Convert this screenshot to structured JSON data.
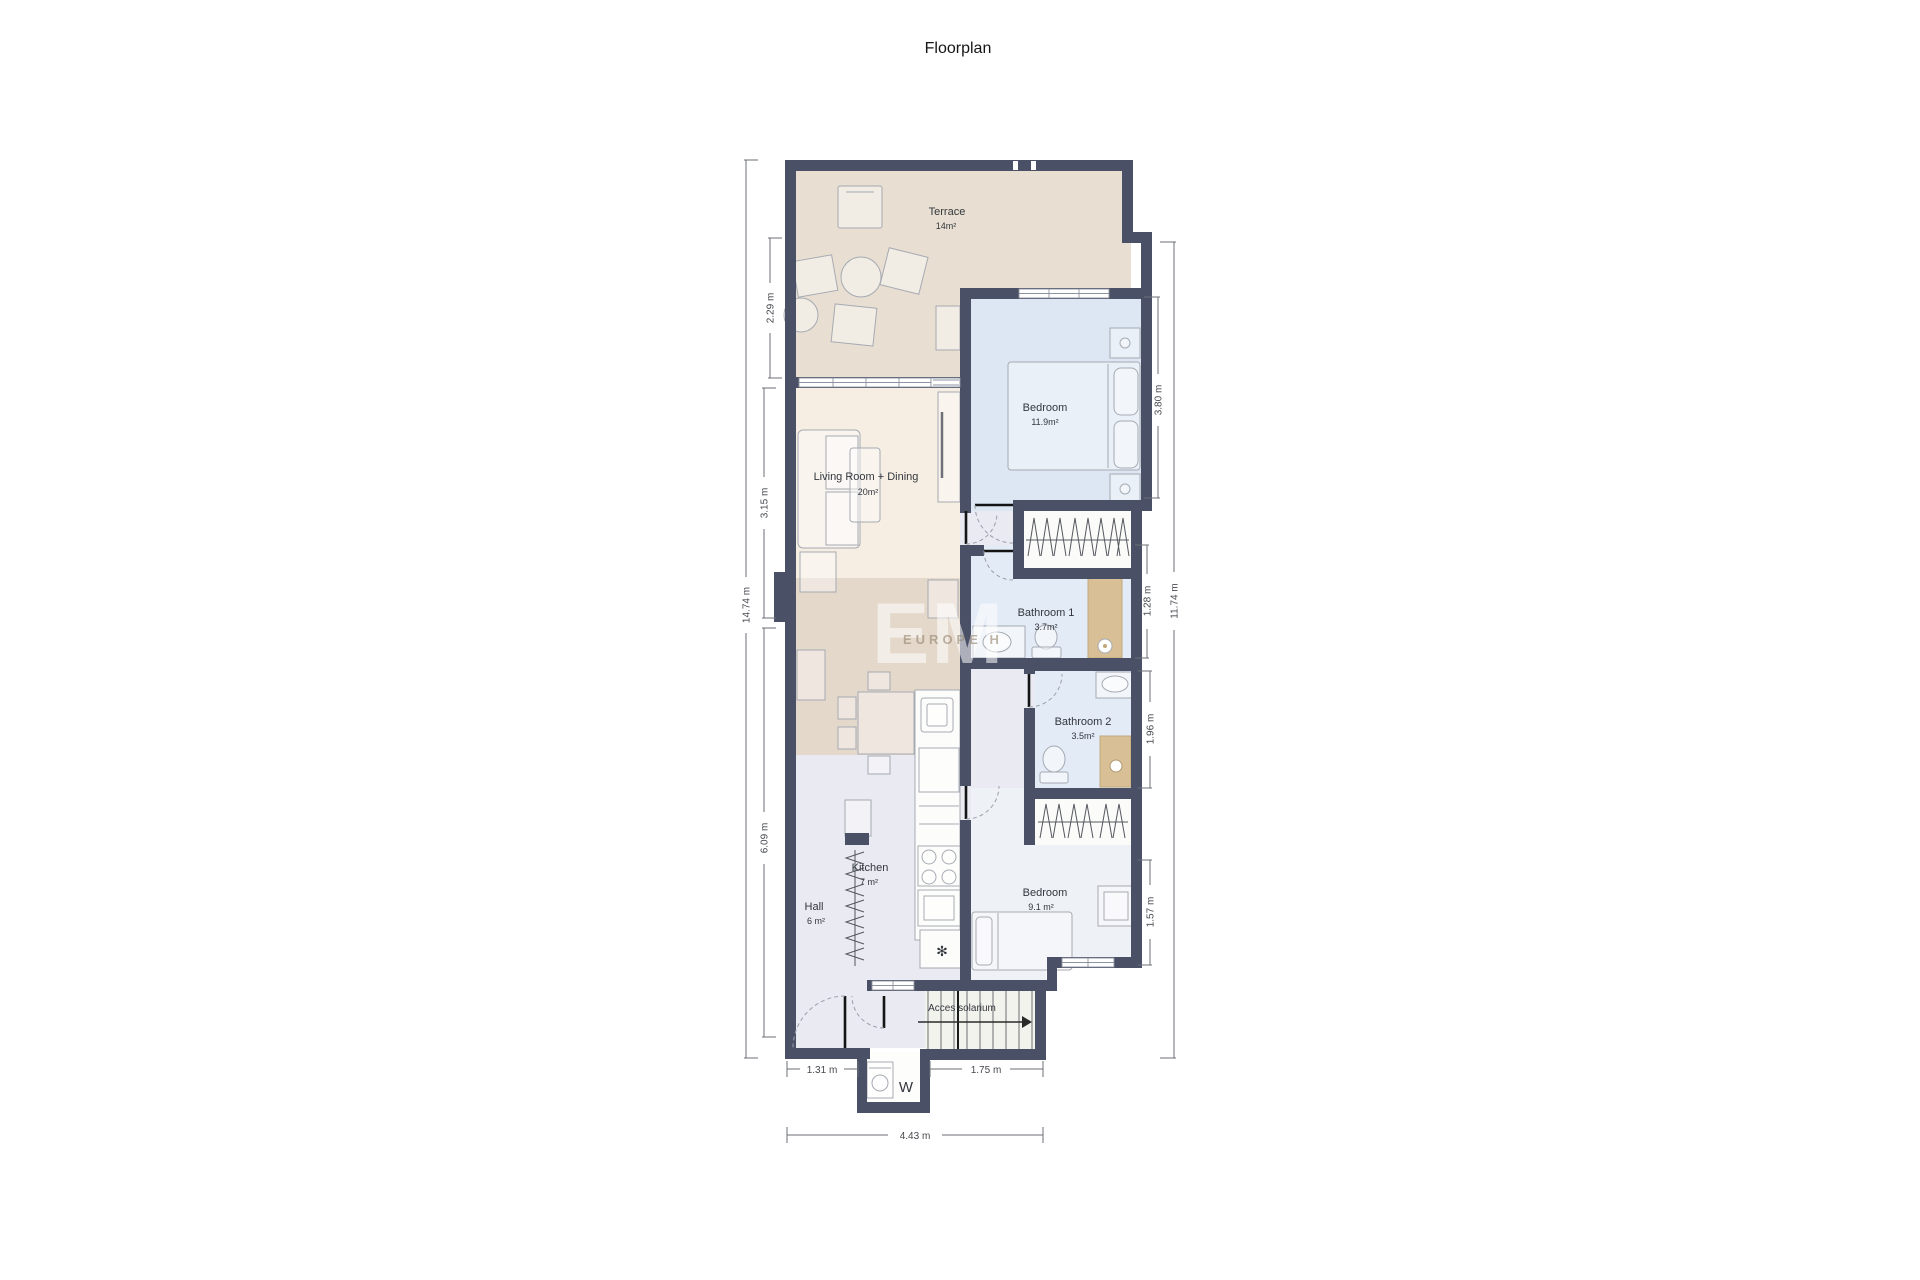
{
  "title": "Floorplan",
  "watermark": {
    "logo": "EM",
    "text": "EUROPE H"
  },
  "rooms": {
    "terrace": {
      "name": "Terrace",
      "area": "14m²"
    },
    "living": {
      "name": "Living Room + Dining",
      "area": "20m²"
    },
    "bedroom1": {
      "name": "Bedroom",
      "area": "11.9m²"
    },
    "bathroom1": {
      "name": "Bathroom 1",
      "area": "3.7m²"
    },
    "bathroom2": {
      "name": "Bathroom 2",
      "area": "3.5m²"
    },
    "kitchen": {
      "name": "Kitchen",
      "area": "7 m²"
    },
    "hall": {
      "name": "Hall",
      "area": "6 m²"
    },
    "bedroom2": {
      "name": "Bedroom",
      "area": "9.1 m²"
    },
    "stairs": {
      "name": "Acces solarium"
    },
    "laundry": {
      "name": "W"
    }
  },
  "dimensions": {
    "overall_left": "14.74 m",
    "terrace_left": "2.29 m",
    "living_left": "3.15 m",
    "lower_left": "6.09 m",
    "bedroom1_right": "3.80 m",
    "bathroom1_right": "1.28 m",
    "bathroom2_right": "1.96 m",
    "bedroom2_right": "1.57 m",
    "overall_right": "11.74 m",
    "hall_bottom": "1.31 m",
    "stairs_bottom": "1.75 m",
    "overall_bottom": "4.43 m"
  },
  "colors": {
    "wall": "#4a5066",
    "terrace": "#e8dfd2",
    "living": "#f6ede3",
    "dining": "#e4d8ca",
    "bedroom": "#dde6f3",
    "bathroom": "#e3ebf7",
    "circulation": "#e9eaf2",
    "bedroom_small": "#eef1f6",
    "shower": "#d8bf95",
    "stairs_area": "#f3f3ee"
  }
}
